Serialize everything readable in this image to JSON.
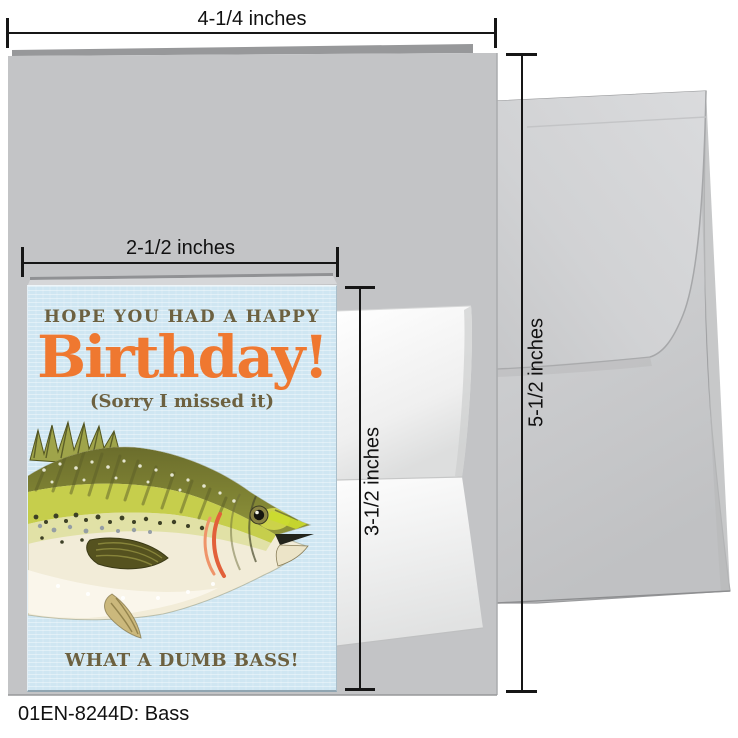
{
  "colors": {
    "accent_orange": "#ef7830",
    "text_olive": "#6d6140",
    "card_blue": "#cfe6f2",
    "gray_card": "#c3c4c6",
    "envelope_gray": "#cdced0",
    "dim_line": "#161616"
  },
  "card_front": {
    "line1": "HOPE YOU HAD A HAPPY",
    "line2": "Birthday!",
    "line3": "(Sorry I missed it)",
    "line4": "WHAT A DUMB BASS!",
    "illustration": "bass-fish"
  },
  "measurements": {
    "open_card_width": "4-1/4 inches",
    "folded_card_width": "2-1/2 inches",
    "folded_card_height": "3-1/2 inches",
    "envelope_height": "5-1/2 inches"
  },
  "footer": {
    "sku": "01EN-8244D: Bass"
  }
}
